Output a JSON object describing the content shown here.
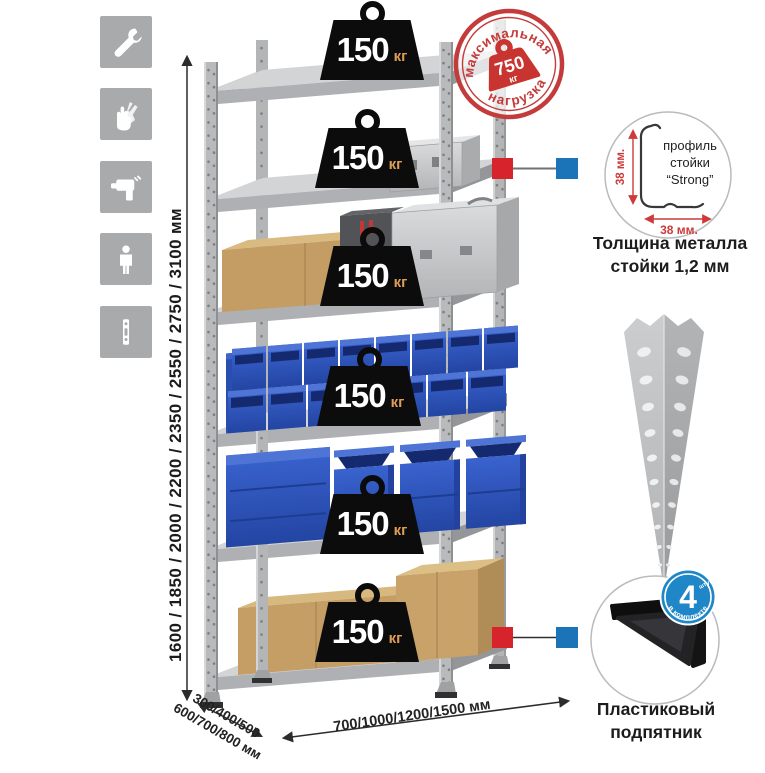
{
  "icon_rail": {
    "icons": [
      {
        "name": "wrench-icon"
      },
      {
        "name": "gloves-icon"
      },
      {
        "name": "drill-icon"
      },
      {
        "name": "person-icon"
      },
      {
        "name": "profile-strip-icon"
      }
    ]
  },
  "dimensions": {
    "height_label": "1600 / 1850 / 2000 / 2200 / 2350 / 2550 / 2750 / 3100 мм",
    "depth_line1": "300/400/500",
    "depth_line2": "600/700/800 мм",
    "width_label": "700/1000/1200/1500 мм"
  },
  "max_load_stamp": {
    "arc_top": "максимальная",
    "arc_bottom": "нагрузка",
    "value": "750",
    "unit": "кг"
  },
  "shelf_badges": [
    {
      "value": "150",
      "unit": "кг"
    },
    {
      "value": "150",
      "unit": "кг"
    },
    {
      "value": "150",
      "unit": "кг"
    },
    {
      "value": "150",
      "unit": "кг"
    },
    {
      "value": "150",
      "unit": "кг"
    },
    {
      "value": "150",
      "unit": "кг"
    }
  ],
  "profile_detail": {
    "label_line1": "профиль",
    "label_line2": "стойки",
    "label_line3": "“Strong”",
    "dim_side": "38 мм.",
    "dim_bottom": "38 мм.",
    "caption_line1": "Толщина металла",
    "caption_line2": "стойки 1,2 мм"
  },
  "foot_detail": {
    "badge_value": "4",
    "badge_note": "штуки",
    "badge_arc": "в комплекте",
    "caption_line1": "Пластиковый",
    "caption_line2": "подпятник"
  },
  "colors": {
    "accent_red": "#c43b3b",
    "connector_red": "#d7232b",
    "connector_blue": "#1b74b8",
    "bin_blue": "#2e55b8",
    "metal_gray": "#b7b9bb"
  }
}
